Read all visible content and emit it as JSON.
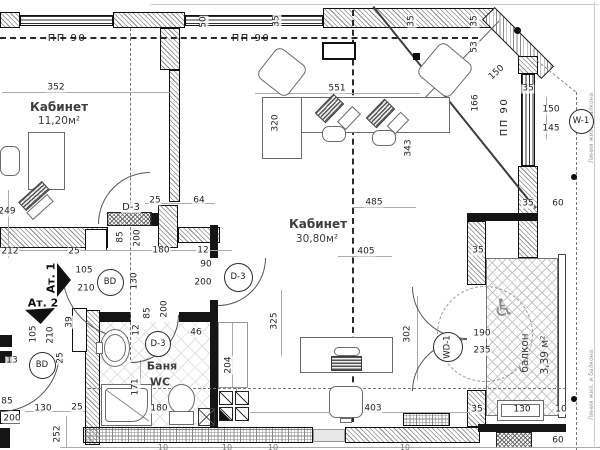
{
  "document": {
    "type": "architectural floor plan",
    "language": "ru"
  },
  "rooms": [
    {
      "name": "Кабинет",
      "sub": "11,20м²"
    },
    {
      "name": "Кабинет",
      "sub": "30,80м²"
    },
    {
      "name": "Баня",
      "sub": "WC"
    },
    {
      "name": "балкон",
      "sub": "3,39 м²"
    }
  ],
  "icons": {
    "wheelchair": "♿"
  },
  "circle_tags": [
    {
      "t": "BD",
      "x": 109,
      "y": 281,
      "d": 25,
      "n": "door-tag-bd-1"
    },
    {
      "t": "BD",
      "x": 41,
      "y": 364,
      "d": 25,
      "n": "door-tag-bd-2"
    },
    {
      "t": "D-3",
      "x": 237,
      "y": 276,
      "d": 27,
      "n": "door-tag-d3-room"
    },
    {
      "t": "D-3",
      "x": 157,
      "y": 343,
      "d": 24,
      "n": "door-tag-d3-bath"
    },
    {
      "t": "W-1",
      "x": 580,
      "y": 120,
      "d": 23,
      "n": "window-tag-w1"
    },
    {
      "t": "WD-1",
      "x": 447,
      "y": 346,
      "d": 28,
      "r": -90,
      "n": "door-tag-wd1-balcony"
    }
  ],
  "labels": [
    {
      "t": "50",
      "x": 204,
      "y": 22,
      "r": -90
    },
    {
      "t": "35",
      "x": 277,
      "y": 21,
      "r": -90
    },
    {
      "t": "35",
      "x": 412,
      "y": 21,
      "r": -90
    },
    {
      "t": "35",
      "x": 475,
      "y": 21,
      "r": -90
    },
    {
      "t": "ПП 90",
      "x": 67,
      "y": 39,
      "c": "wlab",
      "n": "window-type-label"
    },
    {
      "t": "ПП 90",
      "x": 251,
      "y": 39,
      "c": "wlab",
      "n": "window-type-label"
    },
    {
      "t": "ПП 90",
      "x": 505,
      "y": 117,
      "r": -90,
      "c": "wlab",
      "n": "window-type-label"
    },
    {
      "t": "352",
      "x": 56,
      "y": 88
    },
    {
      "t": "551",
      "x": 337,
      "y": 89
    },
    {
      "t": "53",
      "x": 475,
      "y": 47,
      "r": -90
    },
    {
      "t": "150",
      "x": 497,
      "y": 73,
      "r": -42
    },
    {
      "t": "166",
      "x": 476,
      "y": 103,
      "r": -90
    },
    {
      "t": "35",
      "x": 528,
      "y": 89
    },
    {
      "t": "150",
      "x": 551,
      "y": 110
    },
    {
      "t": "145",
      "x": 551,
      "y": 129
    },
    {
      "t": "320",
      "x": 276,
      "y": 123,
      "r": -90
    },
    {
      "t": "343",
      "x": 409,
      "y": 148,
      "r": -90
    },
    {
      "t": "249",
      "x": 7,
      "y": 212
    },
    {
      "t": "212",
      "x": 10,
      "y": 252
    },
    {
      "t": "25",
      "x": 74,
      "y": 252
    },
    {
      "t": "25",
      "x": 155,
      "y": 201
    },
    {
      "t": "64",
      "x": 199,
      "y": 201
    },
    {
      "t": "D-3",
      "x": 131,
      "y": 208,
      "c": "dtag",
      "n": "door-label-d3"
    },
    {
      "t": "85",
      "x": 121,
      "y": 237,
      "r": -90
    },
    {
      "t": "200",
      "x": 138,
      "y": 238,
      "r": -90
    },
    {
      "t": "180",
      "x": 161,
      "y": 251
    },
    {
      "t": "12",
      "x": 203,
      "y": 251
    },
    {
      "t": "90",
      "x": 206,
      "y": 265
    },
    {
      "t": "200",
      "x": 203,
      "y": 283
    },
    {
      "t": "485",
      "x": 374,
      "y": 203
    },
    {
      "t": "405",
      "x": 366,
      "y": 252
    },
    {
      "t": "105",
      "x": 84,
      "y": 271
    },
    {
      "t": "210",
      "x": 86,
      "y": 289
    },
    {
      "t": "Ат. 1",
      "x": 51,
      "y": 278,
      "r": -90,
      "c": "atl",
      "n": "apartment-entry-label"
    },
    {
      "t": "Ат. 2",
      "x": 43,
      "y": 303,
      "c": "atl",
      "n": "apartment-entry-label"
    },
    {
      "t": "105",
      "x": 34,
      "y": 334,
      "r": -90
    },
    {
      "t": "210",
      "x": 51,
      "y": 335,
      "r": -90
    },
    {
      "t": "13",
      "x": 12,
      "y": 361
    },
    {
      "t": "39",
      "x": 70,
      "y": 322,
      "r": -90
    },
    {
      "t": "25",
      "x": 61,
      "y": 358,
      "r": -90
    },
    {
      "t": "130",
      "x": 135,
      "y": 281,
      "r": -90
    },
    {
      "t": "85",
      "x": 148,
      "y": 313,
      "r": -90
    },
    {
      "t": "200",
      "x": 165,
      "y": 309,
      "r": -90
    },
    {
      "t": "12",
      "x": 137,
      "y": 330,
      "r": -90
    },
    {
      "t": "46",
      "x": 196,
      "y": 333
    },
    {
      "t": "171",
      "x": 136,
      "y": 387,
      "r": -90
    },
    {
      "t": "180",
      "x": 159,
      "y": 409
    },
    {
      "t": "204",
      "x": 229,
      "y": 365,
      "r": -90
    },
    {
      "t": "325",
      "x": 275,
      "y": 321,
      "r": -90
    },
    {
      "t": "252",
      "x": 58,
      "y": 434,
      "r": -90
    },
    {
      "t": "85",
      "x": 7,
      "y": 402
    },
    {
      "t": "200",
      "x": 12,
      "y": 419
    },
    {
      "t": "130",
      "x": 43,
      "y": 409
    },
    {
      "t": "25",
      "x": 77,
      "y": 408
    },
    {
      "t": "302",
      "x": 408,
      "y": 334,
      "r": -90
    },
    {
      "t": "403",
      "x": 373,
      "y": 409
    },
    {
      "t": "190",
      "x": 482,
      "y": 334
    },
    {
      "t": "235",
      "x": 482,
      "y": 351
    },
    {
      "t": "35",
      "x": 478,
      "y": 251
    },
    {
      "t": "35",
      "x": 528,
      "y": 204
    },
    {
      "t": "60",
      "x": 558,
      "y": 204
    },
    {
      "t": "35",
      "x": 477,
      "y": 410
    },
    {
      "t": "130",
      "x": 522,
      "y": 410
    },
    {
      "t": "10",
      "x": 561,
      "y": 410
    },
    {
      "t": "60",
      "x": 558,
      "y": 441
    },
    {
      "t": "10",
      "x": 163,
      "y": 448,
      "c": "dim-s"
    },
    {
      "t": "10",
      "x": 227,
      "y": 448,
      "c": "dim-s"
    },
    {
      "t": "10",
      "x": 273,
      "y": 448,
      "c": "dim-s"
    },
    {
      "t": "10",
      "x": 405,
      "y": 448,
      "c": "dim-s"
    },
    {
      "t": "Линия жил. и балкона",
      "x": 592,
      "y": 128,
      "r": -90,
      "c": "note",
      "n": "edge-note"
    },
    {
      "t": "Линия жил. и балкона",
      "x": 592,
      "y": 385,
      "r": -90,
      "c": "note",
      "n": "edge-note"
    }
  ]
}
